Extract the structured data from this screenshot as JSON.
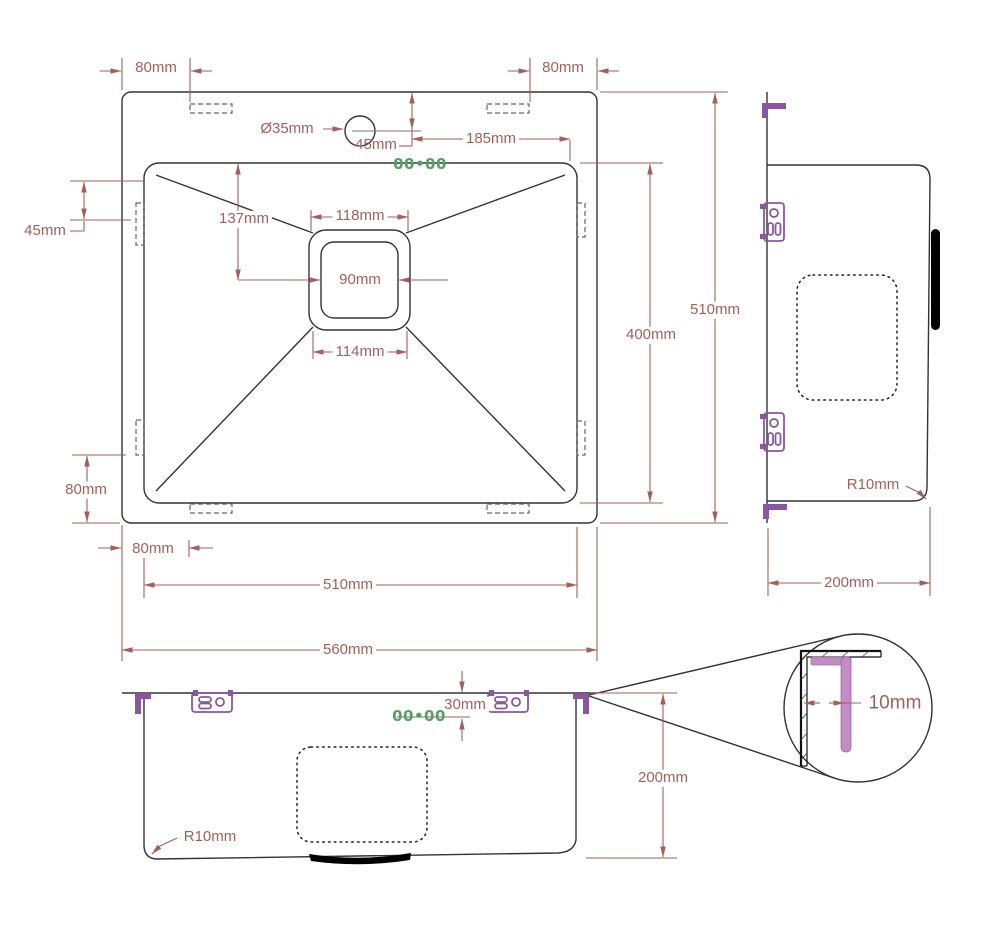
{
  "colors": {
    "dim": "#a26158",
    "line": "#333333",
    "purple": "#8a56a3",
    "pink": "#c48cc4",
    "green": "#55a065"
  },
  "labels": {
    "top_offset_left": "80mm",
    "top_offset_right": "80mm",
    "faucet_hole_diameter": "Ø35mm",
    "faucet_hole_from_top": "45mm",
    "faucet_to_bowl_edge": "185mm",
    "bowl_top_to_drain": "137mm",
    "drain_top_width": "118mm",
    "drain_opening_width": "90mm",
    "drain_bottom_width": "114mm",
    "left_edge_to_slot": "45mm",
    "slot_to_bottom_edge": "80mm",
    "bottom_offset_left": "80mm",
    "bowl_width": "510mm",
    "overall_width": "560mm",
    "bowl_length": "400mm",
    "overall_length": "510mm",
    "side_corner_radius": "R10mm",
    "side_depth": "200mm",
    "rim_height": "30mm",
    "front_depth": "200mm",
    "front_corner_radius": "R10mm",
    "detail_gap": "10mm",
    "marking_top_view": "00•00",
    "marking_front_view": "00•00"
  }
}
